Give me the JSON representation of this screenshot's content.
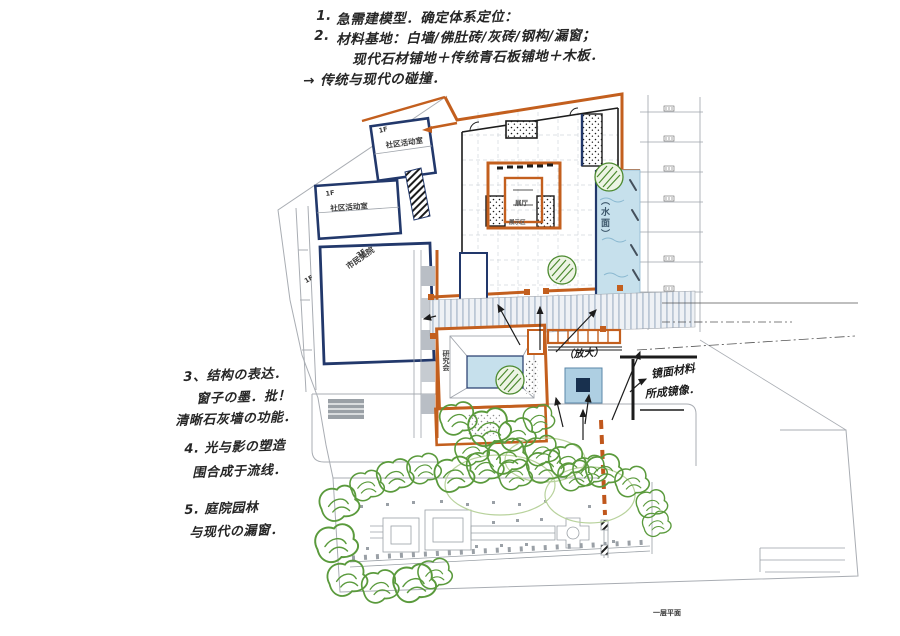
{
  "page": {
    "title": "hand-drawn first-floor site plan sketch",
    "background": "#ffffff"
  },
  "notes_top": {
    "item1_no": "1.",
    "item1": "急需建模型．确定体系定位：",
    "item2_no": "2.",
    "item2": "材料基地：白墙/佛肚砖/灰砖/钢构/漏窗；",
    "item2b": "现代石材铺地＋传统青石板铺地＋木板．",
    "arrow_note": "→ 传统与现代の碰撞．"
  },
  "notes_left": {
    "item3_l1": "3、结构の表达．",
    "item3_l2": "窗子の墨．批！",
    "item3_l3": "清晰石灰墙の功能．",
    "item4_l1": "4. 光与影の塑造",
    "item4_l2": "围合成于流线．",
    "item5_l1": "5. 庭院园林",
    "item5_l2": "与现代の漏窗．"
  },
  "plan_labels": {
    "community_room_1": "社区活动室",
    "community_room_2": "社区活动室",
    "floor_1f_a": "1F",
    "floor_1f_b": "1F",
    "floor_1f_c": "1F",
    "museum_floor": "3F",
    "museum_name": "市民美院",
    "exhibition_hall": "展厅",
    "exhibition_area": "展示区",
    "water_label": "（水面）",
    "research_room": "研究会",
    "enlarge_note": "（放大）",
    "mirror_note_line1": "镜面材料",
    "mirror_note_line2": "所成镜像．",
    "plan_caption": "一层平面"
  },
  "colors": {
    "wall_orange": "#c35f1e",
    "ink_blue": "#22386b",
    "water_blue": "#c6e0ec",
    "tree_green": "#5a9a3c",
    "pencil_gray": "#a9adb3",
    "ink_black": "#1c1c1c"
  }
}
